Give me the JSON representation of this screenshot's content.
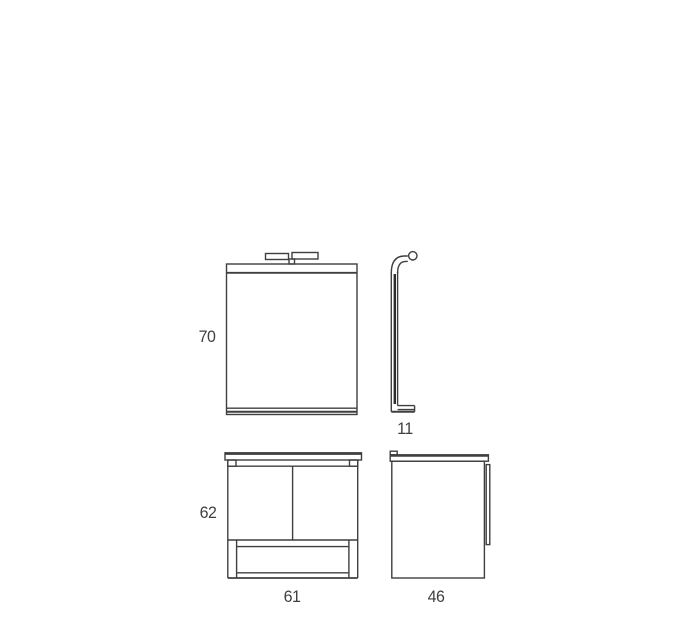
{
  "colors": {
    "background": "#ffffff",
    "line": "#3f3f3f"
  },
  "views": {
    "mirror_front": {
      "height_label": "70"
    },
    "mirror_side": {
      "depth_label": "11"
    },
    "vanity_front": {
      "height_label": "62",
      "width_label": "61"
    },
    "vanity_side": {
      "depth_label": "46"
    }
  }
}
